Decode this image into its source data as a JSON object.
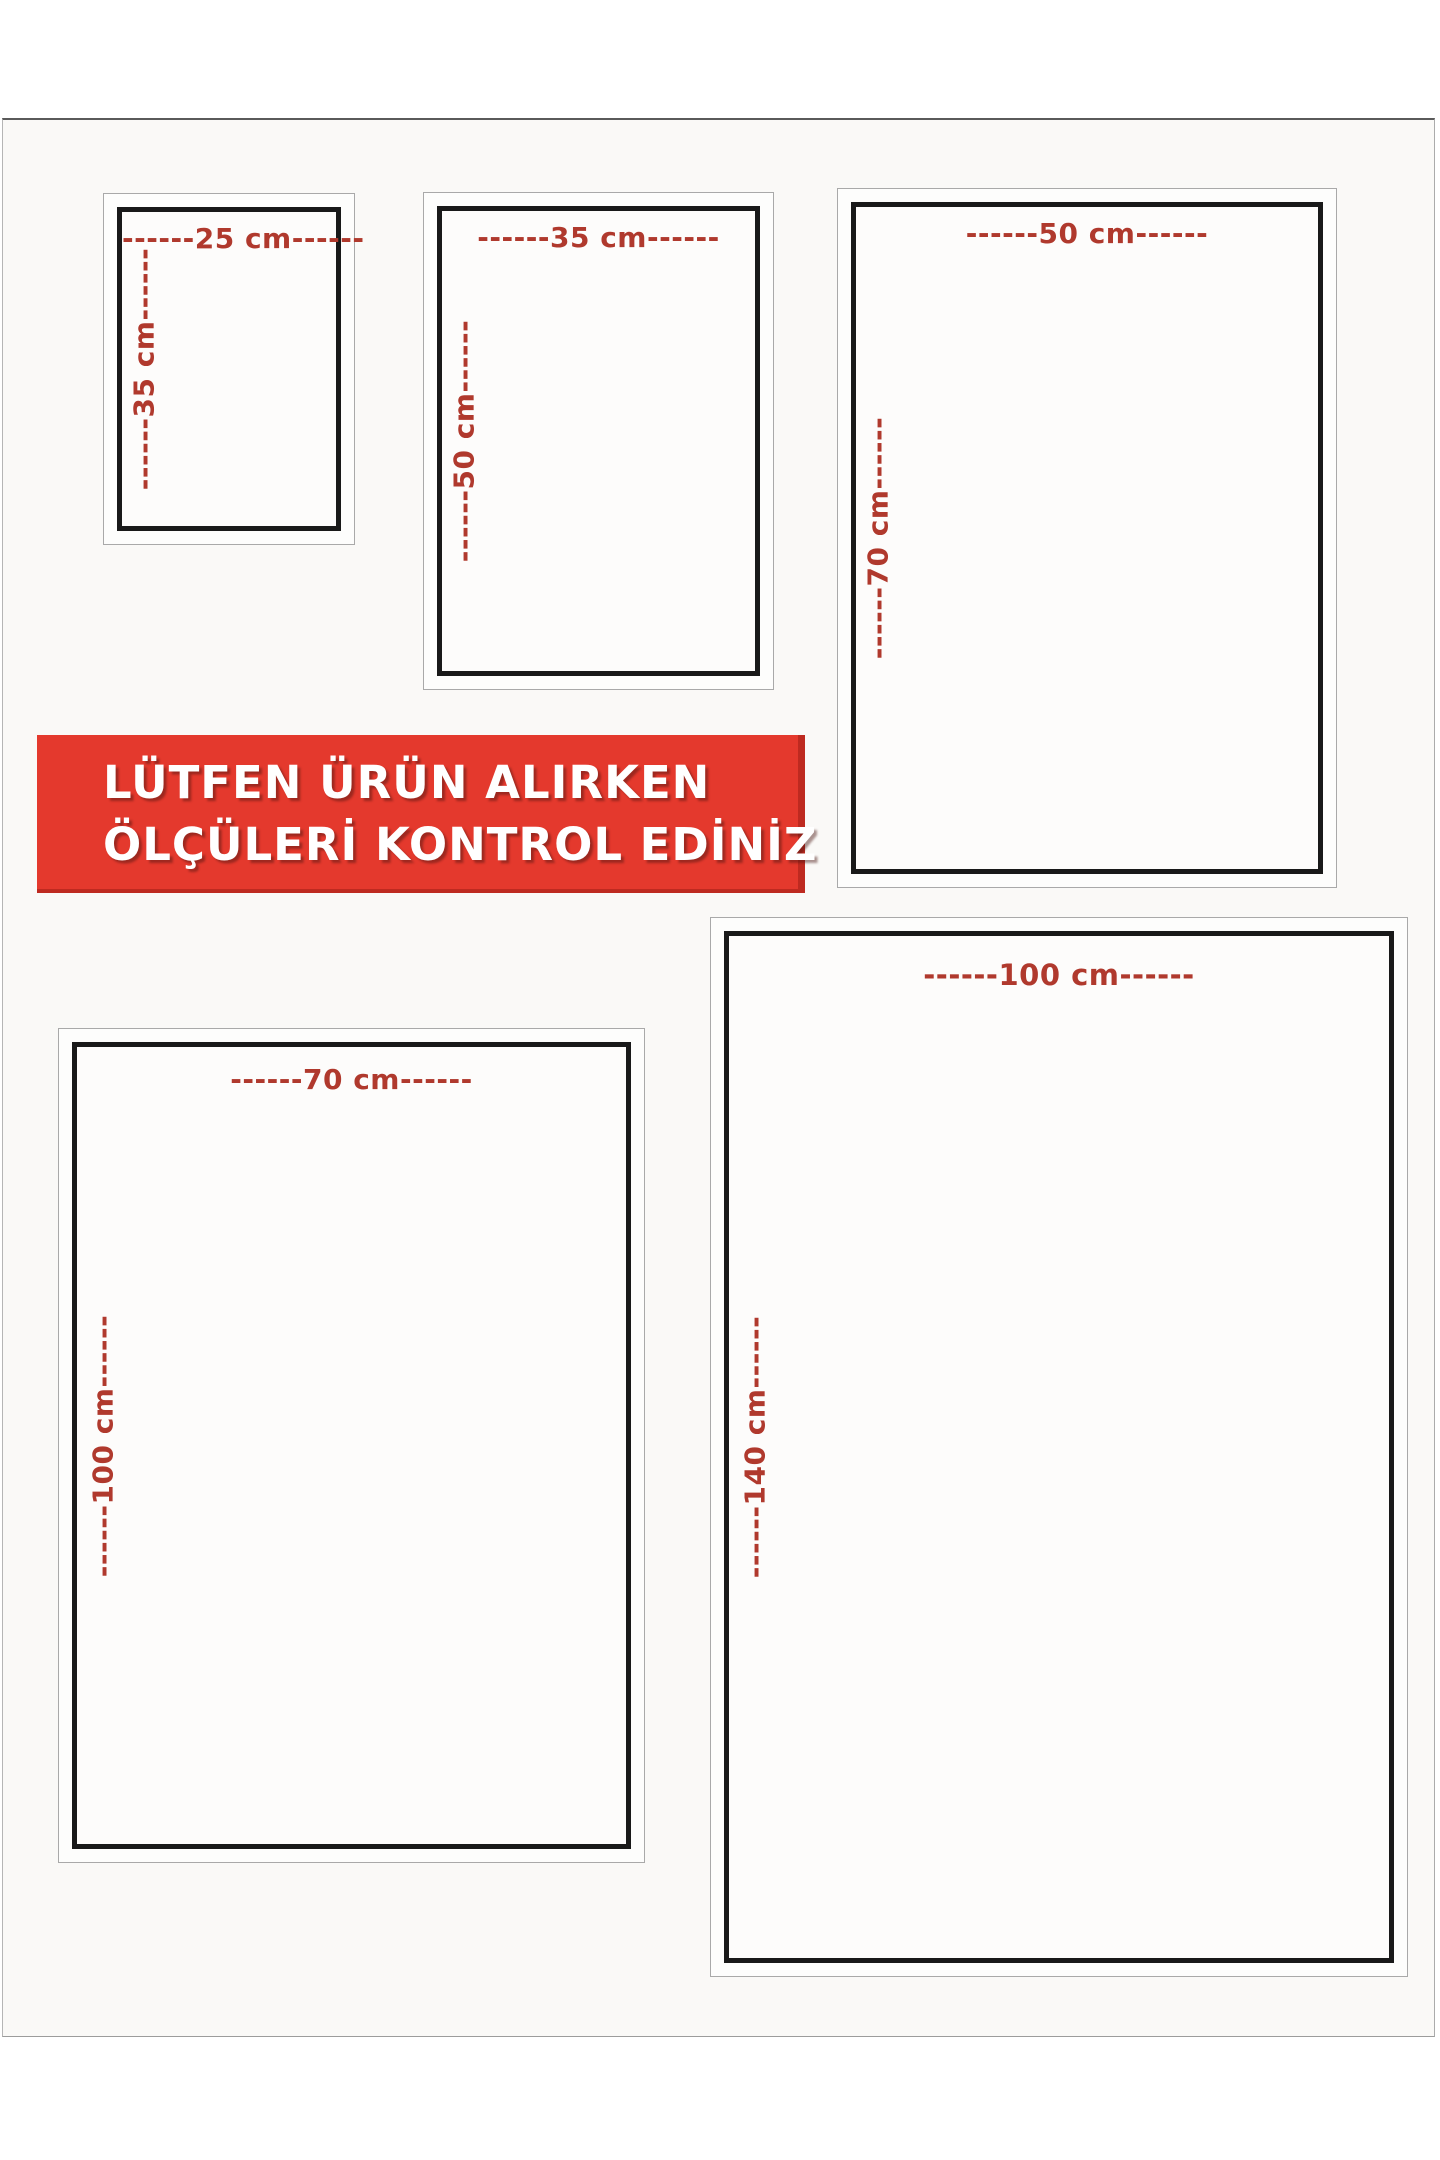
{
  "banner": {
    "line1": "LÜTFEN ÜRÜN ALIRKEN",
    "line2": "ÖLÇÜLERİ KONTROL EDİNİZ"
  },
  "frames": [
    {
      "top_label": "------25 cm------",
      "side_label": "------35 cm------"
    },
    {
      "top_label": "------35 cm------",
      "side_label": "------50 cm------"
    },
    {
      "top_label": "------50 cm------",
      "side_label": "------70 cm------"
    },
    {
      "top_label": "------70 cm------",
      "side_label": "------100 cm------"
    },
    {
      "top_label": "------100 cm------",
      "side_label": "------140 cm------"
    }
  ],
  "colors": {
    "banner_red": "#e4392d",
    "dimension_label_red": "#b0392d",
    "frame_border_black": "#191919",
    "frame_border_gray": "#a9a9a9",
    "page_background": "#faf9f7"
  }
}
